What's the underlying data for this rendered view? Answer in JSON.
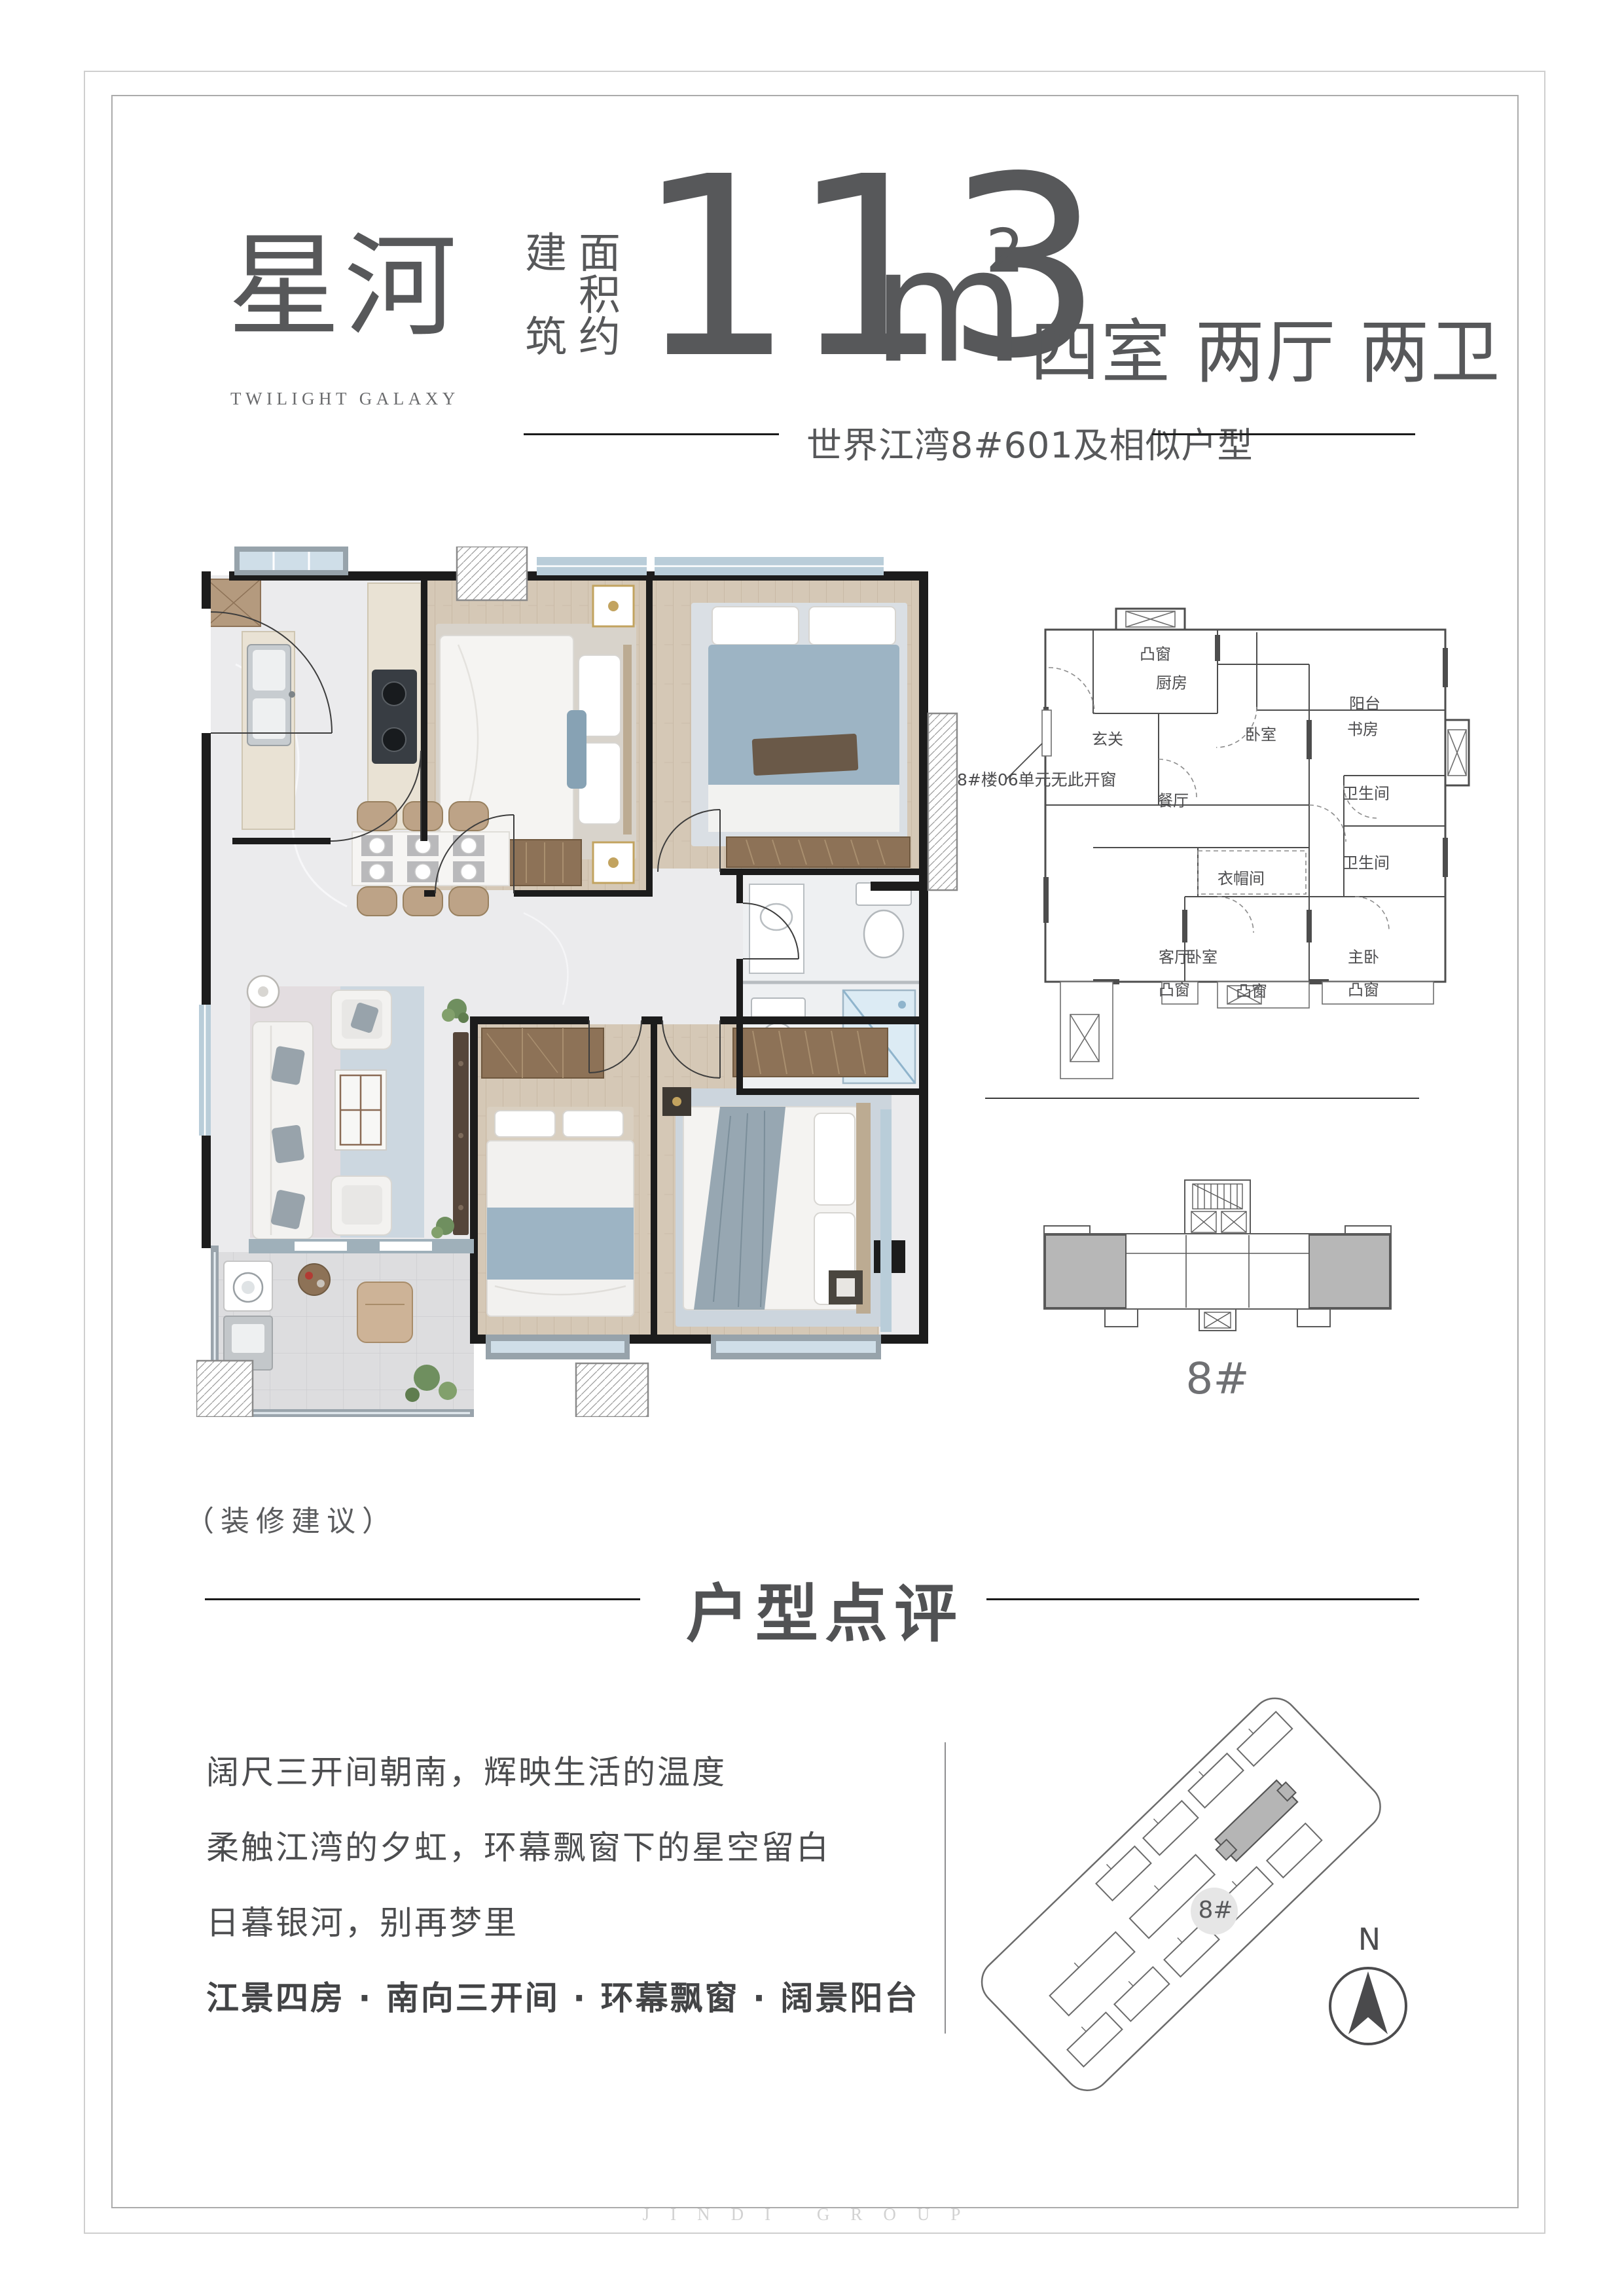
{
  "colors": {
    "text": "#58595b",
    "rule": "#1a1a1a",
    "wall": "#1c1c1c",
    "frame_outer": "#cfcfcf",
    "frame_inner": "#ababab",
    "marble_floor": "#ebebed",
    "wood_floor": "#d5c8b6",
    "window_glass": "#cfdee8",
    "window_frame": "#97a3ab",
    "cabinet_brown": "#8d7257",
    "bed_blue": "#9db4c4",
    "keyplan_shade": "#b7b7b7"
  },
  "header": {
    "title_cn": "星河",
    "title_en": "TWILIGHT GALAXY",
    "area_prefix_col1": "建筑",
    "area_prefix_col2": "面积约",
    "area_value": "113",
    "area_unit": "m",
    "area_sup": "2",
    "layout_spec": "四室 两厅 两卫",
    "location_note": "世界江湾8#601及相似户型"
  },
  "main_plan": {
    "decor_note": "（装修建议）"
  },
  "schematic": {
    "callout": "8#楼06单元无此开窗",
    "labels": [
      "凸窗",
      "厨房",
      "阳台",
      "玄关",
      "卧室",
      "书房",
      "餐厅",
      "卫生间",
      "卫生间",
      "衣帽间",
      "客厅",
      "卧室",
      "主卧",
      "凸窗",
      "凸窗",
      "凸窗"
    ]
  },
  "keyplan": {
    "label": "8#"
  },
  "siteplan": {
    "label": "8#",
    "north": "N"
  },
  "review": {
    "title": "户型点评",
    "lines": [
      "阔尺三开间朝南，辉映生活的温度",
      "柔触江湾的夕虹，环幕飘窗下的星空留白",
      "日暮银河，别再梦里"
    ],
    "highlight": "江景四房 · 南向三开间 · 环幕飘窗 · 阔景阳台"
  },
  "footer": {
    "watermark": "JINDI GROUP"
  }
}
